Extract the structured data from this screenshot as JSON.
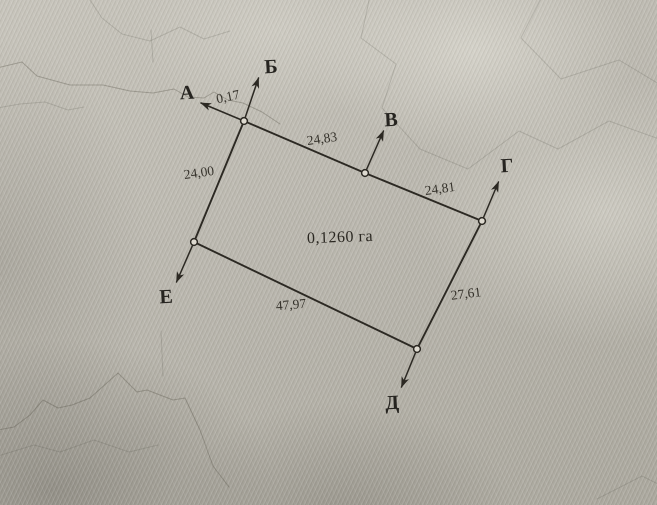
{
  "colors": {
    "ink": "#2c2923",
    "paper_light": "#cdcabf",
    "paper_mid": "#b6b3aa",
    "paper_dark": "#9b978d"
  },
  "parcel": {
    "area_label": "0,1260 га",
    "vertices": [
      "А",
      "Б",
      "В",
      "Г",
      "Д",
      "Е"
    ],
    "sides": [
      {
        "from": "А",
        "to": "Б",
        "length": "0,17"
      },
      {
        "from": "Б",
        "to": "В",
        "length": "24,83"
      },
      {
        "from": "В",
        "to": "Г",
        "length": "24,81"
      },
      {
        "from": "Г",
        "to": "Д",
        "length": "27,61"
      },
      {
        "from": "Д",
        "to": "Е",
        "length": "47,97"
      },
      {
        "from": "Е",
        "to": "А",
        "length": "24,00"
      }
    ]
  }
}
